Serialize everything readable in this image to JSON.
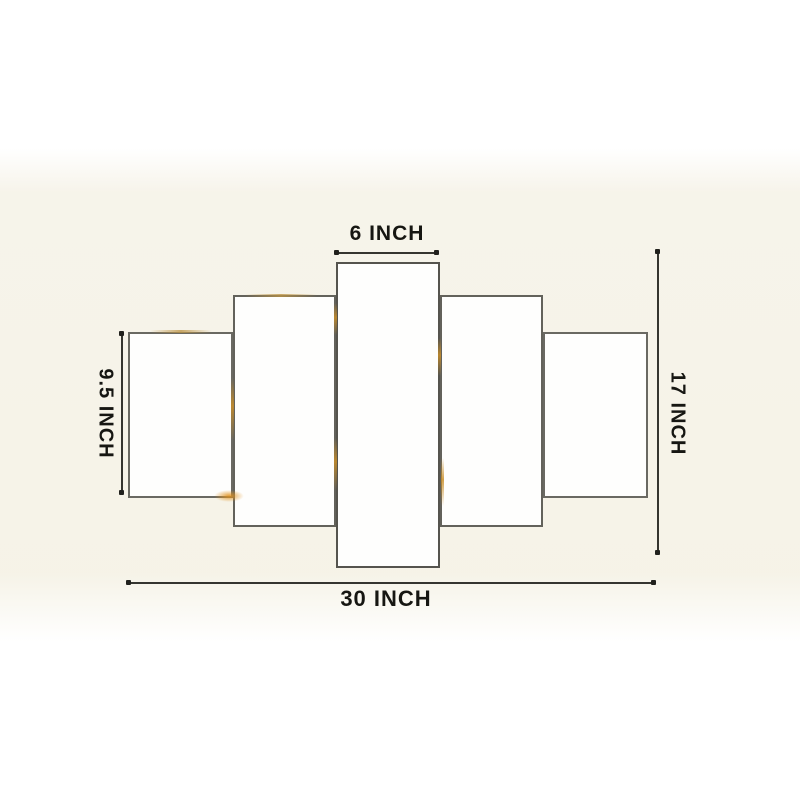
{
  "meta": {
    "description": "Size chart diagram of a 5-piece canvas wall art set on a cream photo background"
  },
  "colors": {
    "photo_background": "#f6f3e9",
    "panel_fill": "#fefefd",
    "panel_border": "#6a6962",
    "dimension_line": "#35352f",
    "label_text": "#161612",
    "edge_glint_gold": "#cd9a2f"
  },
  "panels": {
    "count": 5
  },
  "dimension_labels": {
    "top": "6 INCH",
    "left": "9.5 INCH",
    "right": "17 INCH",
    "bottom": "30 INCH"
  }
}
